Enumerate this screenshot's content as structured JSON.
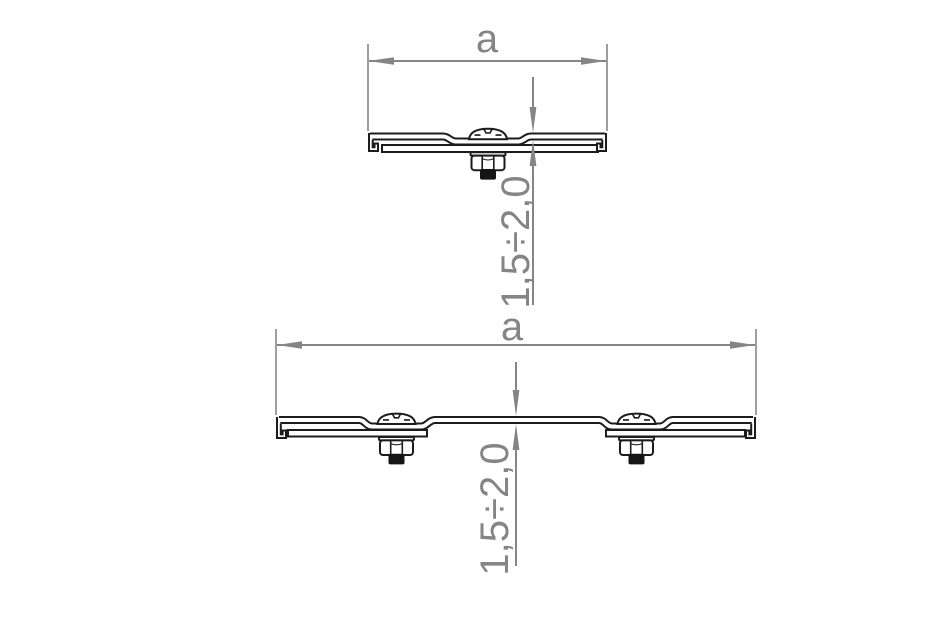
{
  "drawing": {
    "type": "technical-cross-section",
    "background": "#ffffff",
    "colors": {
      "dimension_gray": "#858585",
      "line_black": "#1c1c1c",
      "bolt_tip_fill": "#151515"
    },
    "top_view": {
      "description": "profile section with one bolt",
      "width_label": "a",
      "thickness_label": "1,5÷2,0",
      "bolt_count": 1
    },
    "bottom_view": {
      "description": "wider profile section with two bolts",
      "width_label": "a",
      "thickness_label": "1,5÷2,0",
      "bolt_count": 2
    }
  }
}
